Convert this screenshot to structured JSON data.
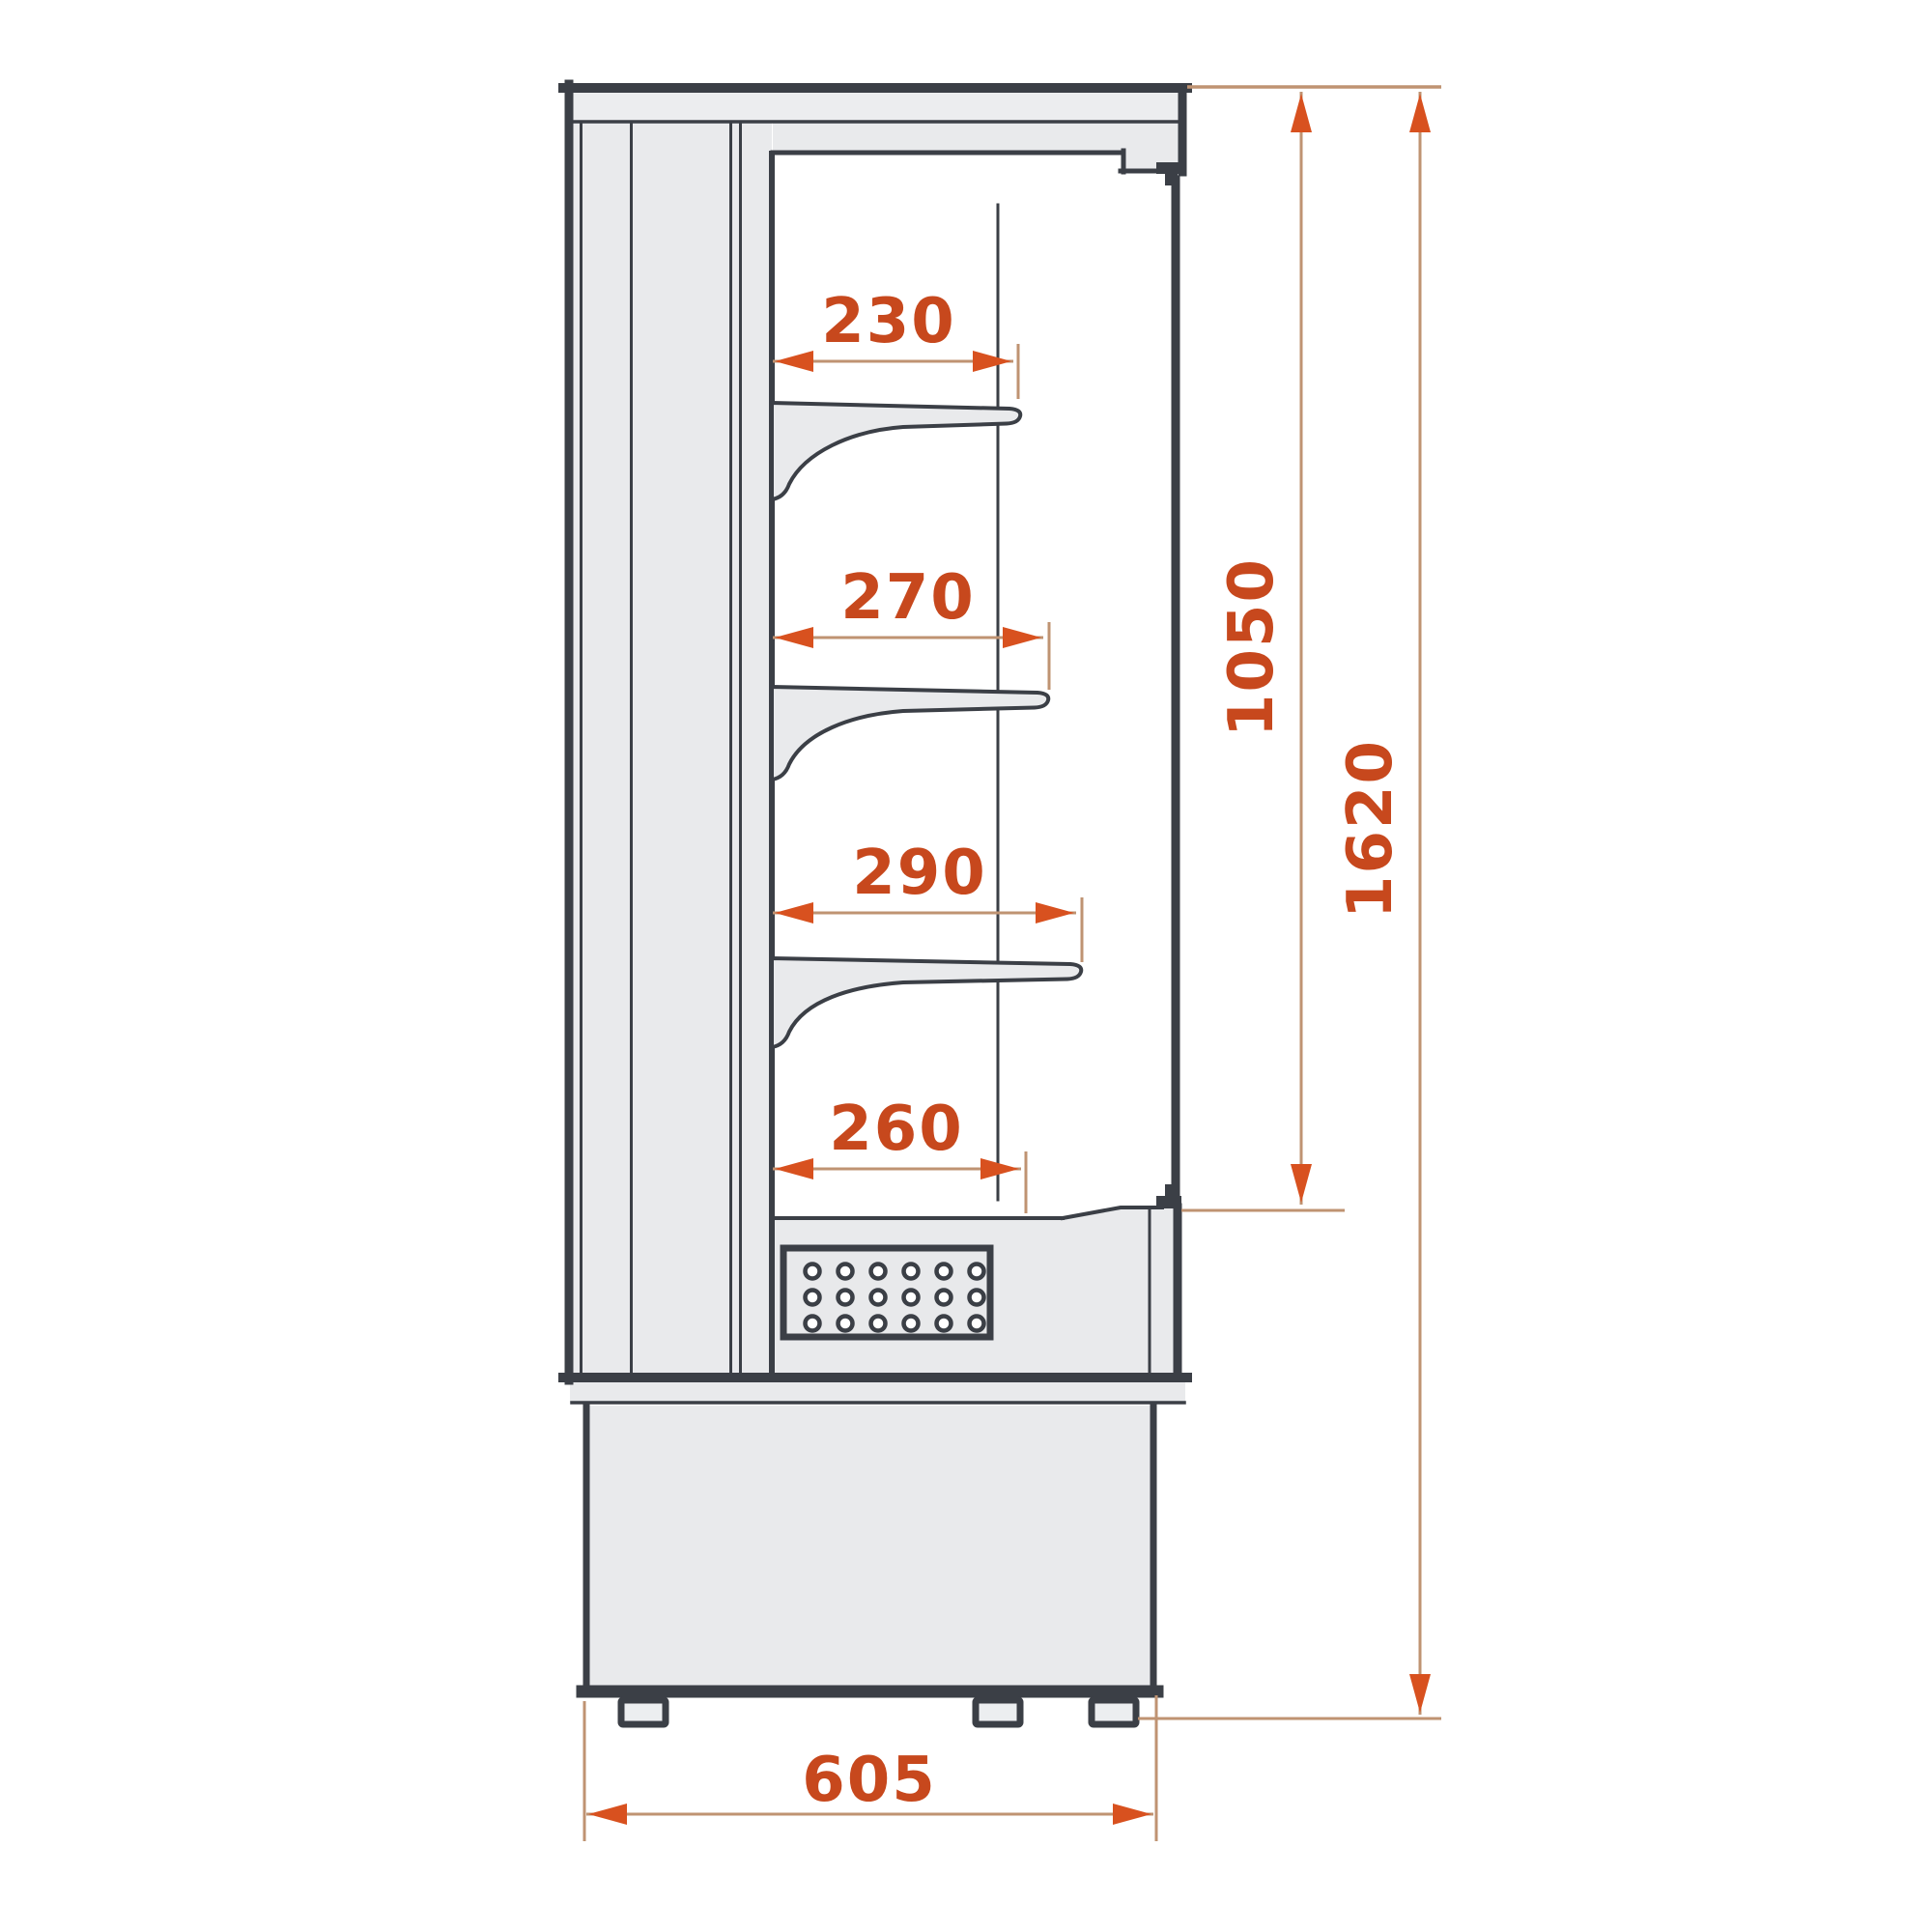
{
  "drawing": {
    "view": "side-section",
    "dim_labels": {
      "shelf1": "230",
      "shelf2": "270",
      "shelf3": "290",
      "bottom_shelf": "260",
      "opening_height": "1050",
      "total_height": "1620",
      "base_depth": "605"
    },
    "colors": {
      "outline": "#3b3f46",
      "panel_fill": "#e9eaec",
      "dim_line": "#bf9372",
      "arrow": "#d8511f",
      "dim_text": "#c7481d",
      "background": "#ffffff"
    }
  }
}
